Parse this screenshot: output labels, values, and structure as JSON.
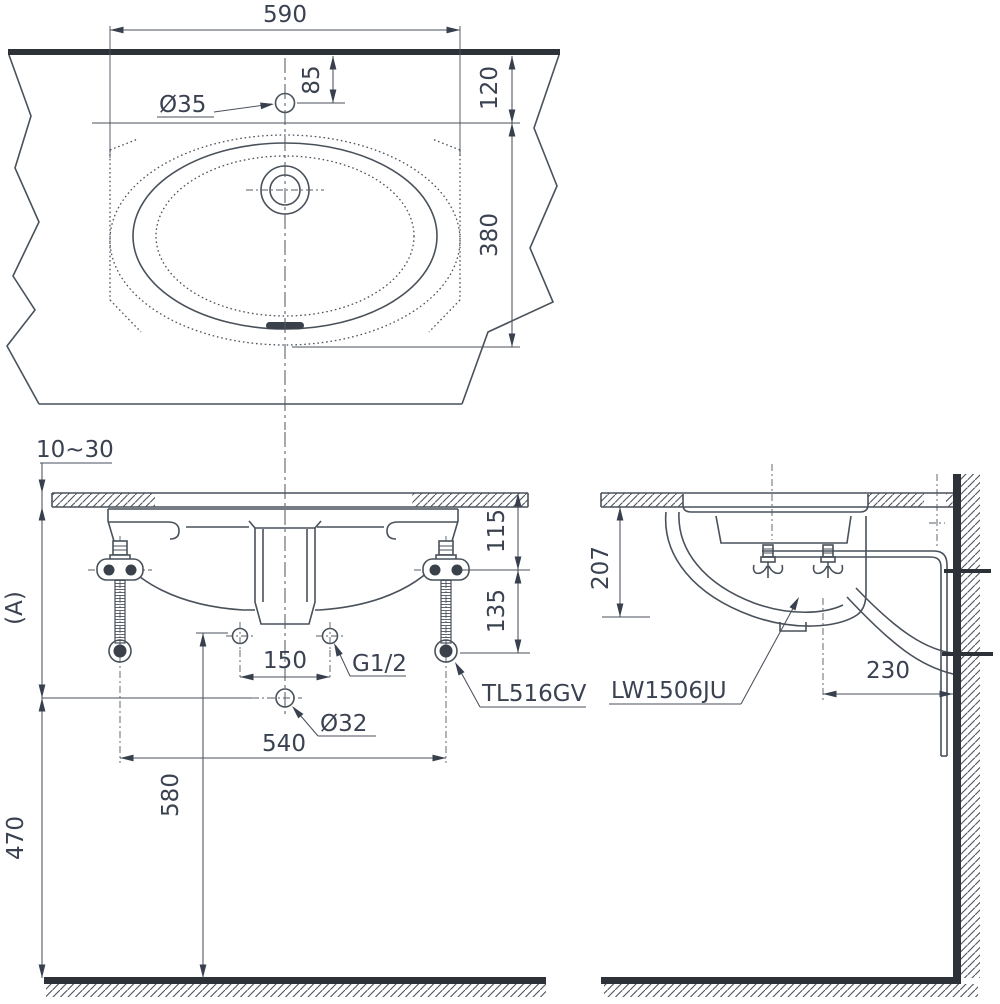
{
  "drawing_title": "Under-counter lavatory installation drawing",
  "ink": {
    "line_color": "#49515a",
    "thick_color": "#2d3238",
    "text_color": "#3a4150"
  },
  "plan_view": {
    "dim_counter_width": "590",
    "dim_faucet_hole_offset": "85",
    "label_faucet_hole_dia": "Ø35",
    "dim_edge_to_cutout": "120",
    "dim_bowl_depth": "380"
  },
  "front_view": {
    "dim_counter_thickness": "10~30",
    "dim_counter_to_drain": "(A)",
    "dim_drain_height_from_floor": "470",
    "dim_supply_height_from_floor": "580",
    "dim_supply_hole_spacing": "150",
    "dim_valve_spacing": "540",
    "dim_counter_to_bracket": "115",
    "dim_bracket_drop": "135",
    "label_supply_thread": "G1/2",
    "label_drain_hole_dia": "Ø32",
    "label_faucet_model": "TL516GV"
  },
  "side_view": {
    "dim_counter_to_bowl_bottom": "207",
    "dim_drain_to_wall": "230",
    "label_basin_model": "LW1506JU"
  }
}
